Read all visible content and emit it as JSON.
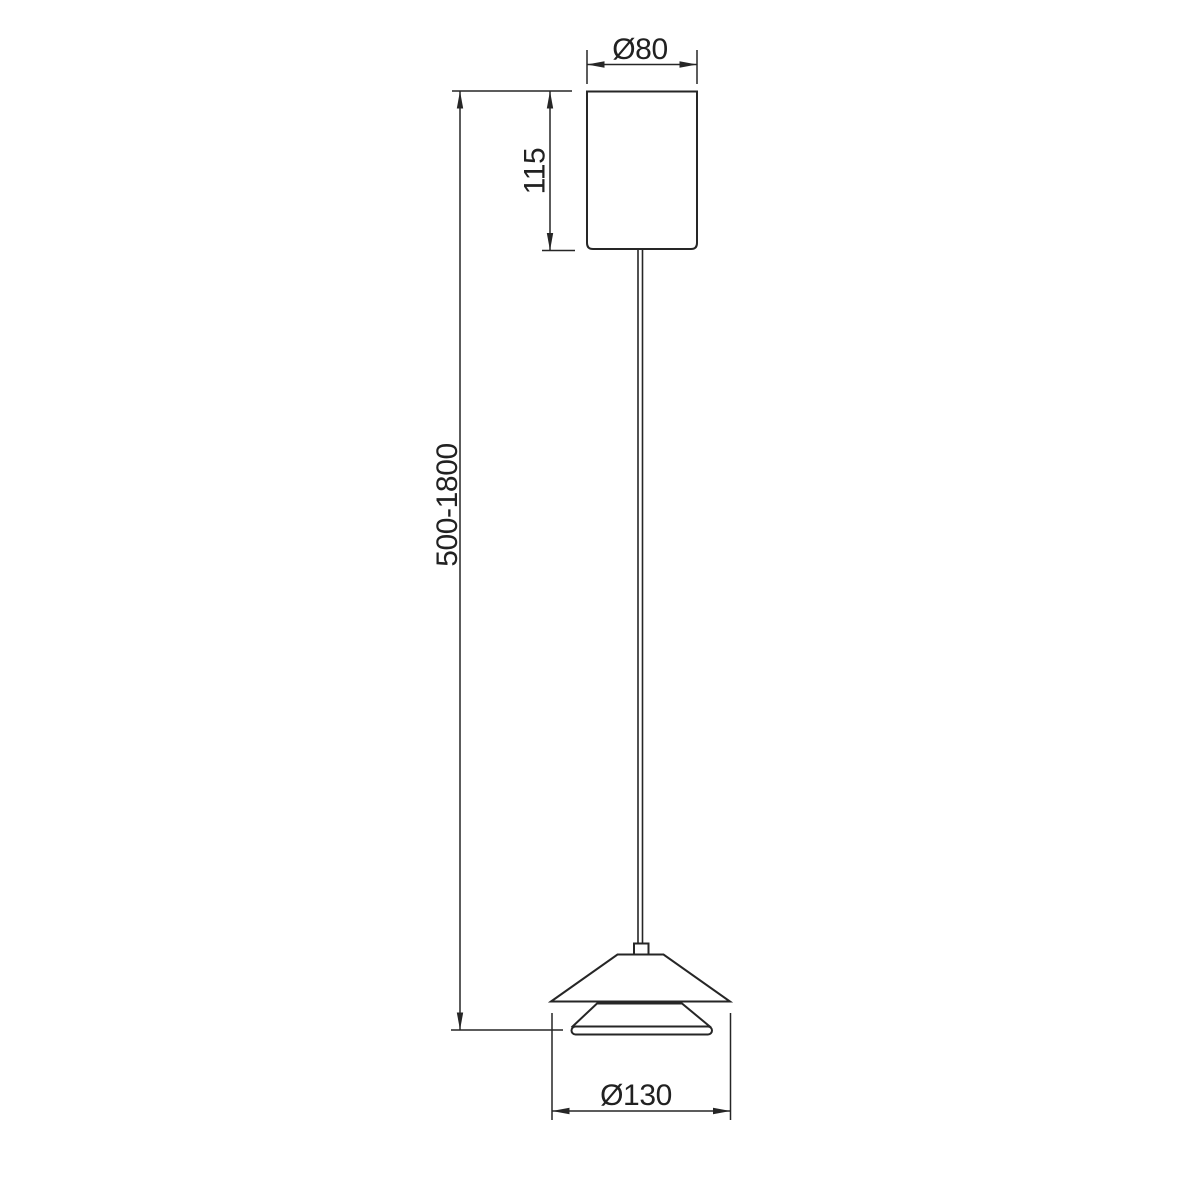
{
  "page": {
    "background_color": "#ffffff"
  },
  "drawing": {
    "kind": "technical-dimension-diagram",
    "subject": "pendant-lamp-side-view",
    "line_color": "#262626",
    "text_color": "#212121",
    "components": [
      {
        "id": "canopy",
        "name": "ceiling-canopy-cylinder"
      },
      {
        "id": "cable",
        "name": "suspension-cable"
      },
      {
        "id": "grip",
        "name": "cable-grip"
      },
      {
        "id": "shade_cone",
        "name": "shade-top-cone"
      },
      {
        "id": "shade_tier",
        "name": "shade-inner-tier"
      },
      {
        "id": "diffuser",
        "name": "shade-diffuser"
      }
    ],
    "dimensions": [
      {
        "id": "canopy-diameter",
        "label": "Ø80",
        "orientation": "horizontal"
      },
      {
        "id": "canopy-height",
        "label": "115",
        "orientation": "vertical"
      },
      {
        "id": "suspension-length",
        "label": "500-1800",
        "orientation": "vertical"
      },
      {
        "id": "shade-diameter",
        "label": "Ø130",
        "orientation": "horizontal"
      }
    ]
  }
}
